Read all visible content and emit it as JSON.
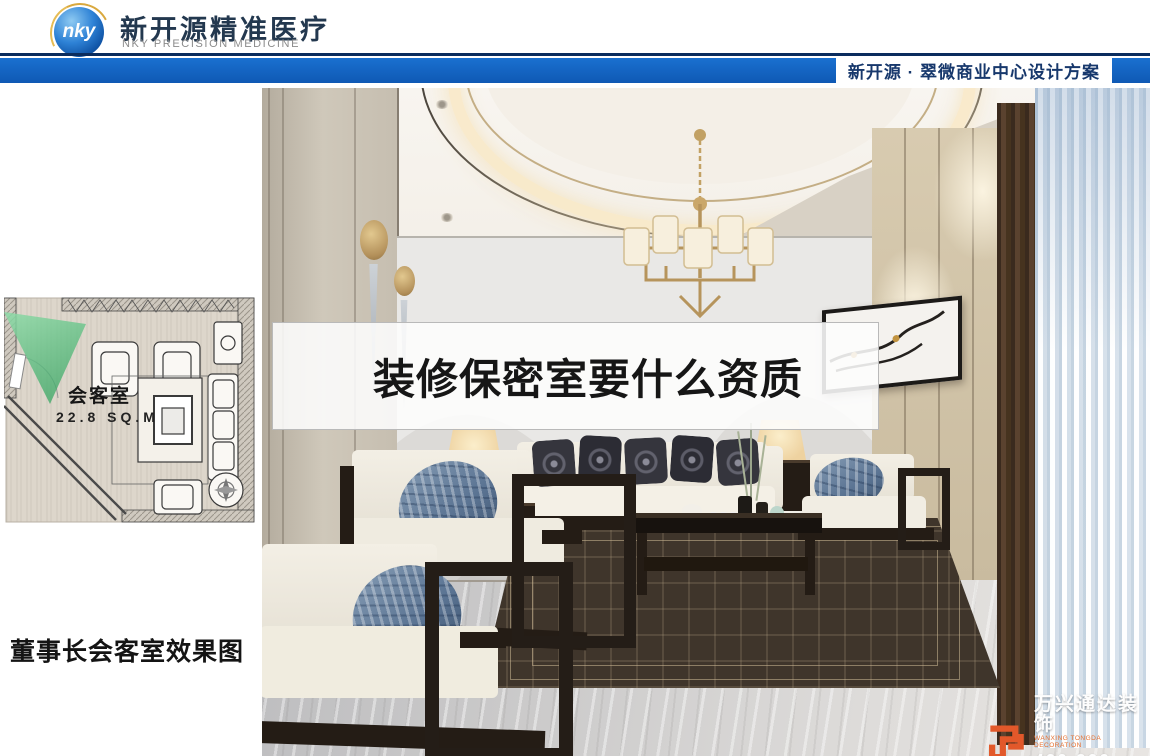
{
  "header": {
    "logo_monogram": "nky",
    "company_cn": "新开源精准医疗",
    "company_en": "NKY PRECISION MEDICINE",
    "banner_text": "新开源 · 翠微商业中心设计方案"
  },
  "plan": {
    "room_name": "会客室",
    "room_area": "22.8 SQ.M",
    "caption": "董事长会客室效果图"
  },
  "overlay": {
    "headline": "装修保密室要什么资质"
  },
  "watermark": {
    "company_cn": "万兴通达装饰",
    "company_en": "WANXING TONGDA DECORATION",
    "phone": "400-900-4560"
  },
  "colors": {
    "banner_blue": "#1262c2",
    "banner_navy": "#0a2c5e",
    "banner_text_blue": "#17386c",
    "watermark_orange": "#e2582a",
    "cone_green": "#57c27d"
  }
}
